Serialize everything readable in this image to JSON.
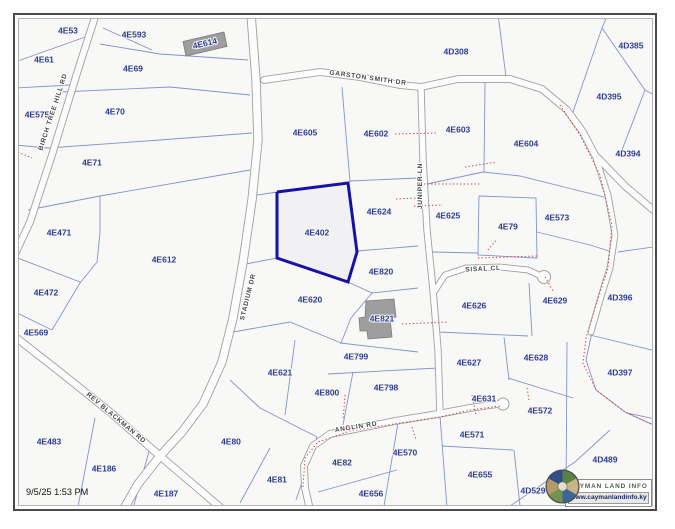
{
  "map": {
    "timestamp": "9/5/25 1:53 PM",
    "selected_parcel": "4E402",
    "colors": {
      "background": "#f8f8f6",
      "parcel_line": "#8593c9",
      "highlight": "#1612a8",
      "dotted": "#c84040",
      "road_casing": "#a0a0a0",
      "road_fill": "#fcfcfc",
      "building": "#9e9e9e",
      "building_stroke": "#7c7c7c",
      "parcel_label": "#2e3c95",
      "road_label": "#47474b"
    },
    "highlight_polygon": [
      277,
      192,
      348,
      183,
      357,
      252,
      348,
      282,
      277,
      258,
      277,
      192
    ],
    "parcel_labels": [
      {
        "id": "4E53",
        "x": 68,
        "y": 31
      },
      {
        "id": "4E593",
        "x": 134,
        "y": 35
      },
      {
        "id": "4E614",
        "x": 205,
        "y": 44,
        "r": -13
      },
      {
        "id": "4D308",
        "x": 456,
        "y": 52
      },
      {
        "id": "4D385",
        "x": 631,
        "y": 46
      },
      {
        "id": "4E61",
        "x": 44,
        "y": 60
      },
      {
        "id": "4E69",
        "x": 133,
        "y": 69
      },
      {
        "id": "4D395",
        "x": 609,
        "y": 97
      },
      {
        "id": "4E575",
        "x": 37,
        "y": 115
      },
      {
        "id": "4E70",
        "x": 115,
        "y": 112
      },
      {
        "id": "4E605",
        "x": 305,
        "y": 133
      },
      {
        "id": "4E602",
        "x": 376,
        "y": 134
      },
      {
        "id": "4E603",
        "x": 458,
        "y": 130
      },
      {
        "id": "4E604",
        "x": 526,
        "y": 144
      },
      {
        "id": "4D394",
        "x": 628,
        "y": 154
      },
      {
        "id": "4E71",
        "x": 92,
        "y": 163
      },
      {
        "id": "4E624",
        "x": 379,
        "y": 212
      },
      {
        "id": "4E625",
        "x": 448,
        "y": 216
      },
      {
        "id": "4E79",
        "x": 508,
        "y": 227
      },
      {
        "id": "4E573",
        "x": 557,
        "y": 218
      },
      {
        "id": "4E471",
        "x": 59,
        "y": 233
      },
      {
        "id": "4E402",
        "x": 317,
        "y": 233
      },
      {
        "id": "4E612",
        "x": 164,
        "y": 260
      },
      {
        "id": "4E820",
        "x": 381,
        "y": 272
      },
      {
        "id": "4E472",
        "x": 46,
        "y": 293
      },
      {
        "id": "4E620",
        "x": 310,
        "y": 300
      },
      {
        "id": "4E626",
        "x": 474,
        "y": 306
      },
      {
        "id": "4E629",
        "x": 555,
        "y": 301
      },
      {
        "id": "4D396",
        "x": 620,
        "y": 298
      },
      {
        "id": "4E821",
        "x": 382,
        "y": 319
      },
      {
        "id": "4E569",
        "x": 36,
        "y": 333
      },
      {
        "id": "4E799",
        "x": 356,
        "y": 357
      },
      {
        "id": "4E627",
        "x": 469,
        "y": 363
      },
      {
        "id": "4E628",
        "x": 536,
        "y": 358
      },
      {
        "id": "4D397",
        "x": 620,
        "y": 373
      },
      {
        "id": "4E621",
        "x": 280,
        "y": 373
      },
      {
        "id": "4E798",
        "x": 386,
        "y": 388
      },
      {
        "id": "4E800",
        "x": 327,
        "y": 393
      },
      {
        "id": "4E631",
        "x": 484,
        "y": 399
      },
      {
        "id": "4E572",
        "x": 540,
        "y": 411
      },
      {
        "id": "4E571",
        "x": 472,
        "y": 435
      },
      {
        "id": "4E483",
        "x": 49,
        "y": 442
      },
      {
        "id": "4E80",
        "x": 231,
        "y": 442
      },
      {
        "id": "4D489",
        "x": 605,
        "y": 460
      },
      {
        "id": "4E186",
        "x": 104,
        "y": 469
      },
      {
        "id": "4E82",
        "x": 342,
        "y": 463
      },
      {
        "id": "4E570",
        "x": 405,
        "y": 453
      },
      {
        "id": "4E655",
        "x": 480,
        "y": 475
      },
      {
        "id": "4E81",
        "x": 277,
        "y": 480
      },
      {
        "id": "4E187",
        "x": 166,
        "y": 494
      },
      {
        "id": "4D529",
        "x": 533,
        "y": 491
      },
      {
        "id": "4E656",
        "x": 371,
        "y": 494
      }
    ],
    "road_labels": [
      {
        "text": "BIRCH TREE HILL RD",
        "x": 53,
        "y": 112,
        "r": -72
      },
      {
        "text": "GARSTON SMITH DR",
        "x": 368,
        "y": 78,
        "r": 8
      },
      {
        "text": "JUNIPER LN",
        "x": 420,
        "y": 186,
        "r": -90
      },
      {
        "text": "STADIUM DR",
        "x": 248,
        "y": 297,
        "r": -76
      },
      {
        "text": "SISAL CL",
        "x": 483,
        "y": 269,
        "r": -3
      },
      {
        "text": "ANGLIN RD",
        "x": 356,
        "y": 427,
        "r": -9
      },
      {
        "text": "REV BLACKMAN RD",
        "x": 116,
        "y": 418,
        "r": 40
      }
    ],
    "roads": [
      {
        "id": "birch-tree-hill-rd",
        "w": 6,
        "pts": [
          96,
          14,
          78,
          70,
          52,
          155,
          30,
          222,
          16,
          252
        ]
      },
      {
        "id": "stadium-dr",
        "w": 7.5,
        "pts": [
          251,
          14,
          256,
          80,
          258,
          140,
          252,
          200,
          243,
          262,
          233,
          318,
          222,
          362,
          203,
          404,
          182,
          432,
          160,
          456,
          138,
          484,
          122,
          512
        ]
      },
      {
        "id": "rev-blackman-rd",
        "w": 6.5,
        "pts": [
          14,
          336,
          60,
          372,
          110,
          412,
          160,
          456,
          200,
          490,
          230,
          516
        ]
      },
      {
        "id": "garston-smith-dr",
        "w": 6,
        "pts": [
          264,
          80,
          320,
          72,
          360,
          77,
          400,
          85,
          421,
          87,
          458,
          79,
          510,
          79,
          542,
          89,
          567,
          110,
          583,
          132,
          595,
          155,
          625,
          186,
          658,
          214
        ]
      },
      {
        "id": "garston-south-branch",
        "w": 5,
        "pts": [
          595,
          155,
          608,
          195,
          615,
          235,
          610,
          268,
          600,
          300,
          591,
          332
        ]
      },
      {
        "id": "juniper-ln",
        "w": 5.5,
        "pts": [
          421,
          88,
          423,
          160,
          427,
          230,
          433,
          290,
          438,
          350,
          440,
          414
        ]
      },
      {
        "id": "sisal-cl",
        "w": 5,
        "pts": [
          434,
          292,
          445,
          275,
          466,
          268,
          500,
          267,
          528,
          270,
          541,
          276
        ]
      },
      {
        "id": "anglin-rd",
        "w": 6,
        "pts": [
          311,
          514,
          305,
          488,
          304,
          466,
          313,
          446,
          330,
          434,
          360,
          428,
          395,
          421,
          438,
          414,
          470,
          408,
          497,
          404
        ]
      }
    ],
    "culdesac_bulbs": [
      {
        "x": 544,
        "y": 277,
        "r": 6.5
      },
      {
        "x": 503,
        "y": 404,
        "r": 6
      }
    ],
    "parcel_lines": [
      [
        15,
        62,
        88,
        36
      ],
      [
        15,
        88,
        70,
        85
      ],
      [
        15,
        145,
        48,
        148
      ],
      [
        100,
        44,
        160,
        54,
        248,
        60
      ],
      [
        60,
        92,
        170,
        87,
        250,
        95
      ],
      [
        48,
        148,
        160,
        140,
        252,
        133
      ],
      [
        28,
        210,
        100,
        196
      ],
      [
        100,
        196,
        250,
        170
      ],
      [
        100,
        196,
        100,
        233
      ],
      [
        100,
        233,
        97,
        262,
        80,
        283,
        52,
        330
      ],
      [
        15,
        257,
        80,
        282
      ],
      [
        15,
        312,
        52,
        330
      ],
      [
        103,
        28,
        152,
        50
      ],
      [
        498,
        14,
        506,
        77
      ],
      [
        608,
        14,
        602,
        28
      ],
      [
        602,
        28,
        573,
        112
      ],
      [
        602,
        28,
        645,
        90,
        660,
        98
      ],
      [
        645,
        90,
        622,
        150
      ],
      [
        342,
        87,
        350,
        182
      ],
      [
        350,
        181,
        418,
        178
      ],
      [
        357,
        251,
        418,
        246
      ],
      [
        348,
        282,
        372,
        293,
        418,
        288
      ],
      [
        372,
        293,
        351,
        318,
        341,
        343
      ],
      [
        233,
        332,
        290,
        322,
        341,
        343
      ],
      [
        277,
        258,
        246,
        264
      ],
      [
        277,
        192,
        251,
        196
      ],
      [
        295,
        340,
        285,
        415
      ],
      [
        230,
        380,
        260,
        408,
        317,
        437
      ],
      [
        340,
        343,
        418,
        352
      ],
      [
        328,
        374,
        438,
        368
      ],
      [
        353,
        372,
        343,
        425
      ],
      [
        427,
        184,
        483,
        172
      ],
      [
        485,
        82,
        484,
        172
      ],
      [
        483,
        172,
        520,
        176,
        608,
        198
      ],
      [
        479,
        196,
        536,
        198,
        537,
        258,
        478,
        255,
        479,
        196
      ],
      [
        432,
        252,
        478,
        253
      ],
      [
        537,
        232,
        590,
        245,
        612,
        252
      ],
      [
        660,
        246,
        618,
        252
      ],
      [
        438,
        332,
        528,
        336
      ],
      [
        529,
        283,
        532,
        336
      ],
      [
        504,
        337,
        509,
        380
      ],
      [
        508,
        378,
        573,
        398
      ],
      [
        567,
        342,
        566,
        505
      ],
      [
        590,
        335,
        660,
        352
      ],
      [
        627,
        413,
        660,
        420
      ],
      [
        510,
        506,
        575,
        462,
        610,
        430
      ],
      [
        442,
        446,
        513,
        450
      ],
      [
        514,
        450,
        520,
        506
      ],
      [
        440,
        416,
        447,
        508
      ],
      [
        398,
        423,
        383,
        512
      ],
      [
        318,
        492,
        397,
        470
      ],
      [
        270,
        448,
        240,
        503
      ],
      [
        317,
        437,
        296,
        500
      ],
      [
        95,
        418,
        77,
        512
      ],
      [
        150,
        448,
        132,
        512
      ],
      [
        592,
        332,
        586,
        360,
        596,
        390,
        625,
        412,
        658,
        427
      ]
    ],
    "dotted_lines": [
      [
        395,
        134,
        437,
        133
      ],
      [
        465,
        167,
        497,
        162
      ],
      [
        424,
        184,
        480,
        184
      ],
      [
        396,
        199,
        417,
        198
      ],
      [
        414,
        206,
        443,
        205
      ],
      [
        478,
        258,
        537,
        256
      ],
      [
        488,
        250,
        497,
        239
      ],
      [
        545,
        277,
        553,
        291
      ],
      [
        402,
        324,
        448,
        322
      ],
      [
        303,
        487,
        305,
        458,
        318,
        442,
        350,
        431,
        400,
        423,
        440,
        417,
        470,
        410,
        500,
        406
      ],
      [
        412,
        427,
        416,
        440
      ],
      [
        345,
        395,
        343,
        420
      ],
      [
        560,
        105,
        580,
        135,
        600,
        175,
        612,
        225,
        608,
        268,
        596,
        305,
        586,
        338,
        583,
        363,
        596,
        390,
        625,
        412,
        657,
        427
      ],
      [
        472,
        395,
        476,
        415
      ],
      [
        527,
        388,
        529,
        400
      ],
      [
        18,
        152,
        32,
        158
      ]
    ],
    "buildings": [
      {
        "id": "building-4E614",
        "points": [
          183,
          41.5,
          224,
          32,
          227,
          46.5,
          186,
          56
        ]
      },
      {
        "id": "building-4E821",
        "points": [
          366,
          301,
          394,
          299,
          396,
          317,
          390,
          318,
          392,
          337,
          368,
          339,
          367,
          331,
          360,
          331,
          359,
          318,
          365,
          317
        ]
      }
    ]
  },
  "logo": {
    "title": "CAYMAN LAND INFO",
    "url": "www.caymanlandinfo.ky"
  }
}
